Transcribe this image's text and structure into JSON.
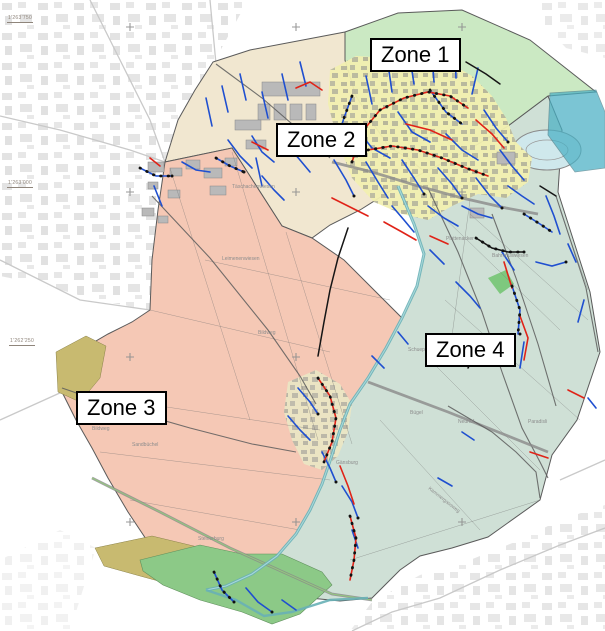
{
  "zones": [
    {
      "label": "Zone 1",
      "color": "#cbe9c3"
    },
    {
      "label": "Zone 2",
      "color": "#f1e7d0"
    },
    {
      "label": "Zone 3",
      "color": "#f5c8b5"
    },
    {
      "label": "Zone 4",
      "color": "#cfe0d6"
    }
  ],
  "coordinate_labels": [
    {
      "text": "1'263'750"
    },
    {
      "text": "1'263'000"
    },
    {
      "text": "1'262'250"
    }
  ],
  "place_labels": [
    {
      "text": "Täschachenwiesen"
    },
    {
      "text": "Leimenenwiesen"
    },
    {
      "text": "Bildweg"
    },
    {
      "text": "Bildweg"
    },
    {
      "text": "Steinerburg"
    },
    {
      "text": "Sandbüchel"
    },
    {
      "text": "Bügel"
    },
    {
      "text": "Gänsburg"
    },
    {
      "text": "Neuhof"
    },
    {
      "text": "Schuepis"
    },
    {
      "text": "Paradisli"
    },
    {
      "text": "Kammergassweg"
    },
    {
      "text": "Plattenacker"
    },
    {
      "text": "Bahnmüliwiesen"
    }
  ],
  "colors": {
    "pipe_blue": "#1f4fd0",
    "pipe_red": "#e02318",
    "pipe_black": "#151515",
    "river": "#68b0b6",
    "teal_overlay": "#49b0c4",
    "town_fill": "#f1efb0",
    "forest_green": "#8cc987",
    "olive": "#c8ba70",
    "background_buildings": "#e2e2e2"
  }
}
